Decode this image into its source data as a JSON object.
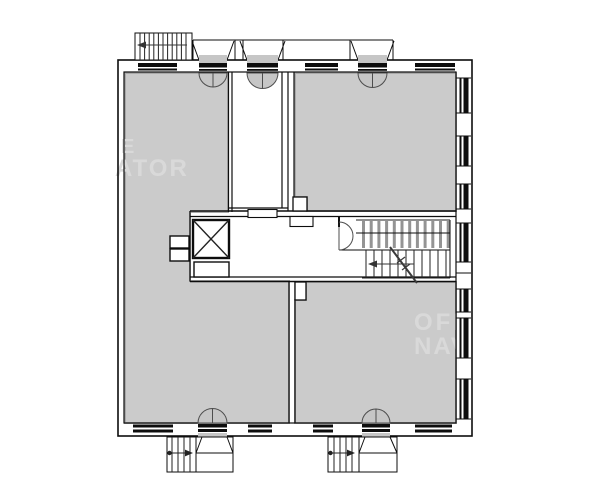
{
  "watermark": {
    "left_line1": "E",
    "left_line2": "ATOR",
    "right_line1": "OFF",
    "right_line2": "NAV"
  },
  "colors": {
    "page_bg": "#ffffff",
    "room_fill": "#cbcbcb",
    "room_edge": "#a9a9a9",
    "wall_line": "#0d0d0d",
    "detail_line": "#222222",
    "tread_fill": "#949494",
    "door_fill": "#c6c6c6",
    "door_stroke": "#4d4d4d",
    "watermark_text": "#d9d9d9"
  }
}
